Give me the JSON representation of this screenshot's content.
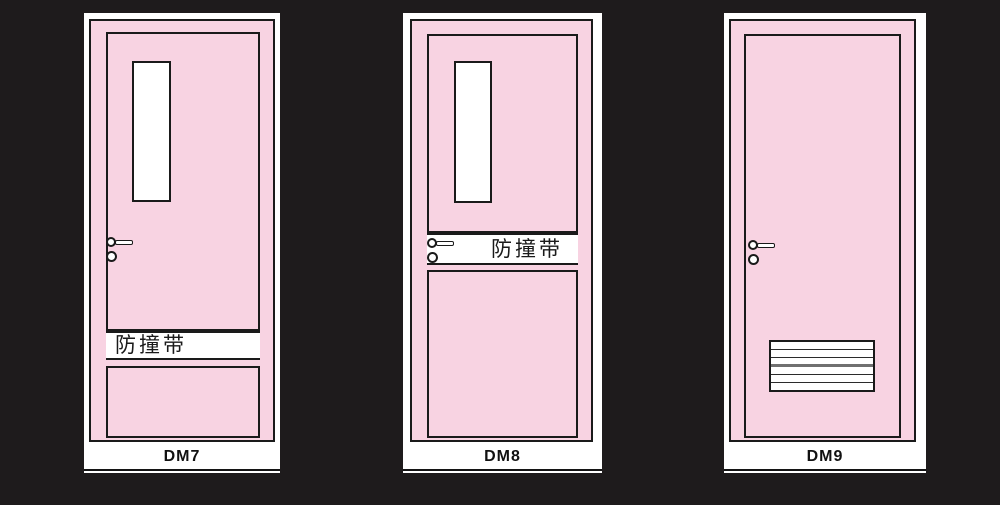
{
  "palette": {
    "background": "#1E1B1C",
    "door_pink": "#F8D3E2",
    "outline": "#1A1A1A",
    "paper_white": "#FFFFFF"
  },
  "doors": [
    {
      "model": "DM7",
      "band_text": "防撞带",
      "has_vision_panel": true,
      "handle": "lever-with-cylinder",
      "band_position": "lower-third"
    },
    {
      "model": "DM8",
      "band_text": "防撞带",
      "has_vision_panel": true,
      "handle": "lever-with-cylinder",
      "band_position": "middle-at-handle"
    },
    {
      "model": "DM9",
      "band_text": "",
      "has_vision_panel": false,
      "handle": "lever-with-cylinder",
      "louver_slats": 6
    }
  ]
}
